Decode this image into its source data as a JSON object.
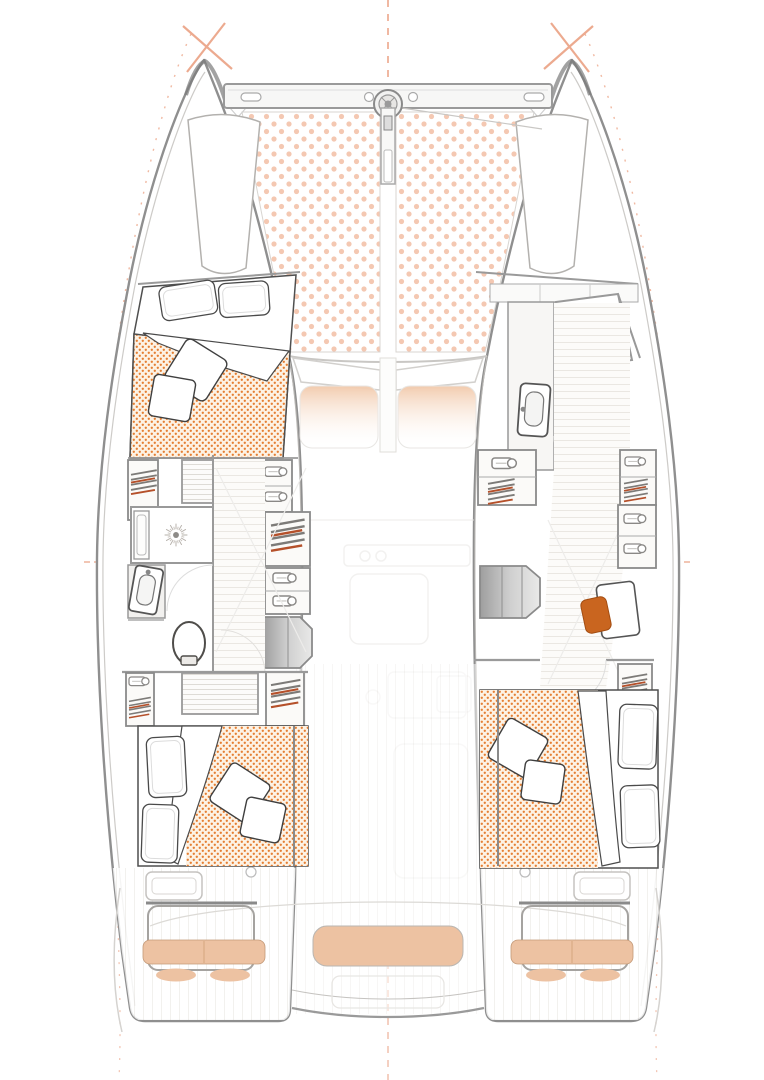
{
  "diagram": {
    "description": "Top-down interior deck plan of a sailing catamaran, bow at top, stern at bottom. No text labels are rendered in the drawing.",
    "regions": {
      "bow": [
        "forward-crossbeam",
        "anchor-windlass",
        "bowsprit",
        "trampoline-port",
        "trampoline-starboard",
        "bow-locker-port",
        "bow-locker-starboard"
      ],
      "port_hull": [
        "forward-cabin-double-bed",
        "hanging-lockers",
        "drawer-units",
        "tambour-cabinet",
        "bathroom-shower",
        "bathroom-sink",
        "bathroom-toilet",
        "corridor-wood-floor",
        "companionway-steps",
        "aft-cabin-double-bed"
      ],
      "starboard_hull": [
        "forward-head-shower",
        "forward-head-sink",
        "forward-head-toilet",
        "hanging-lockers",
        "drawer-units",
        "corridor-wood-floor",
        "companionway-steps",
        "desk",
        "desk-chair",
        "aft-cabin-double-bed"
      ],
      "bridgedeck": [
        "saloon-front-windows",
        "forward-cockpit-seats",
        "saloon-ghost-furniture",
        "aft-cockpit-bench",
        "helm-seats",
        "transom-steps",
        "swim-platforms"
      ]
    },
    "beds": 3,
    "bathrooms": 2
  },
  "colors": {
    "hull_outline": "#8f8f8f",
    "inner_wall": "#9a9a9a",
    "furniture_line": "#4a4a4a",
    "bed_dot": "#e57f33",
    "bed_base": "#fdf2e4",
    "tramp_dot": "#f4c8b2",
    "cushion": "#edc2a2",
    "chair": "#c9651f",
    "hanger_accent": "#b5502a",
    "guide_orange": "#eba183",
    "wood_line": "#eae7e2",
    "ghost_line": "#e9e7e4"
  },
  "icons": [
    "shower-drain-icon",
    "toilet-icon",
    "sink-icon",
    "hangers-icon",
    "drawer-handle-icon",
    "windlass-icon",
    "pillow-icon",
    "cushion-icon"
  ]
}
